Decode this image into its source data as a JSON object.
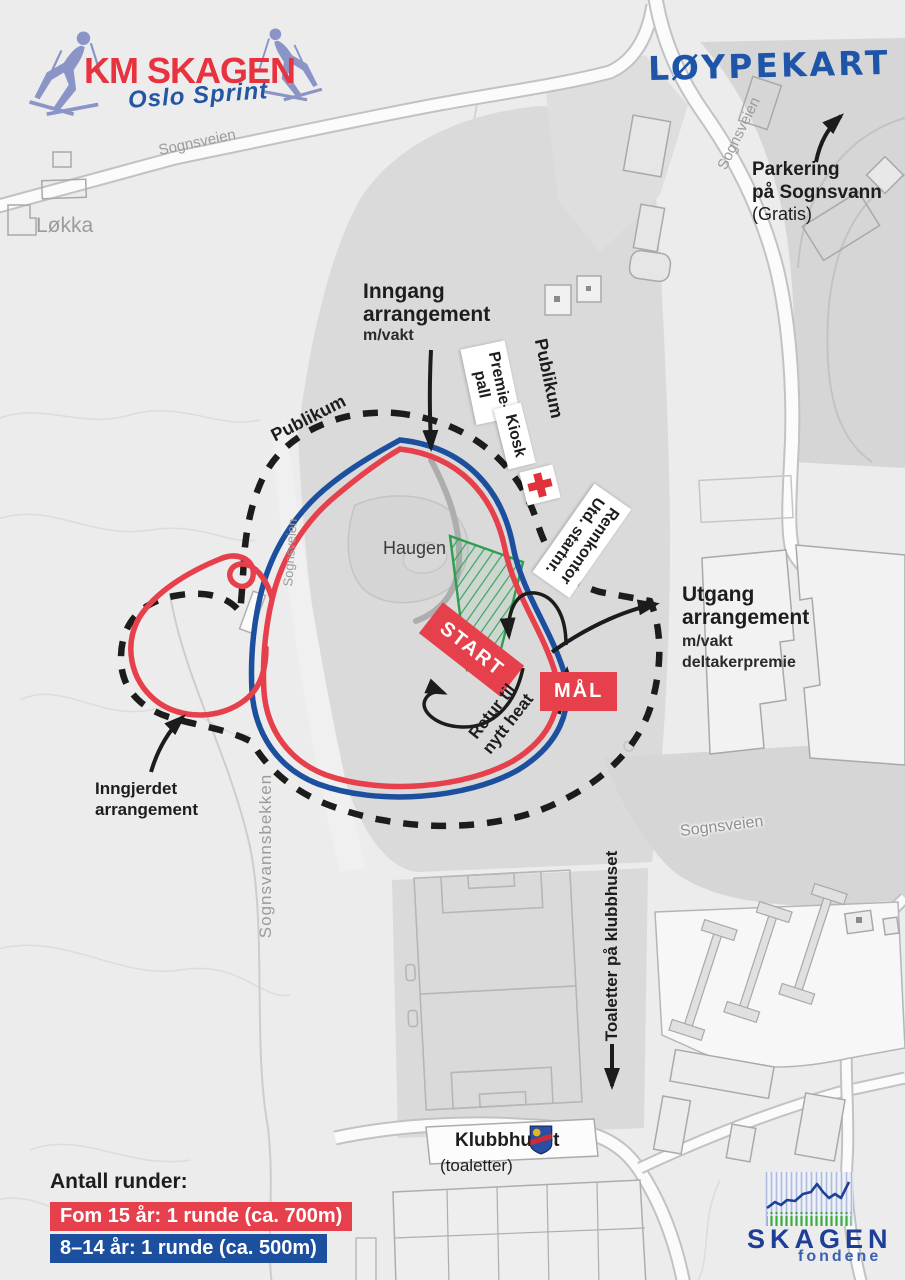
{
  "colors": {
    "course_red": "#e5404b",
    "course_blue": "#1d4f9f",
    "fence_black": "#1c1c1c",
    "start_zone_green": "#3aa659",
    "brand_red": "#e8323e",
    "brand_blue": "#2456a4",
    "logo_blue": "#1e3e97"
  },
  "header": {
    "event_logo": {
      "title": "KM SKAGEN",
      "subtitle": "Oslo Sprint"
    },
    "map_title": "LØYPEKART"
  },
  "annotations": {
    "parking": {
      "line1": "Parkering",
      "line2": "på Sognsvann",
      "line3": "(Gratis)"
    },
    "entrance": {
      "line1": "Inngang",
      "line2": "arrangement",
      "line3": "m/vakt"
    },
    "exit": {
      "line1": "Utgang",
      "line2": "arrangement",
      "line3": "m/vakt",
      "line4": "deltakerpremie"
    },
    "fenced_area": {
      "line1": "Inngjerdet",
      "line2": "arrangement"
    },
    "return_heat": {
      "line1": "Retur til",
      "line2": "nytt heat"
    },
    "toilets": "Toaletter på klubbhuset",
    "clubhouse": {
      "name": "Klubbhuset",
      "note": "(toaletter)"
    }
  },
  "facilities": {
    "podium": {
      "line1": "Premie-",
      "line2": "pall"
    },
    "kiosk": "Kiosk",
    "race_office": {
      "line1": "Rennkontor",
      "line2": "Utd. startnr."
    }
  },
  "course": {
    "start": "START",
    "finish": "MÅL"
  },
  "map_labels": {
    "lokka": "Løkka",
    "haugen": "Haugen",
    "publikum_west": "Publikum",
    "publikum_east": "Publikum",
    "sognsveien_nw": "Sognsveien",
    "sognsveien_ne": "Sognsveien",
    "sognsveien_west": "Sognsveien",
    "sognsveien_se": "Sognsveien",
    "sognsvannsbekken": "Sognsvannsbekken"
  },
  "legend": {
    "title": "Antall runder:",
    "items": [
      {
        "label": "Fom 15 år: 1 runde (ca. 700m)",
        "color": "#e5404b"
      },
      {
        "label": "8–14 år: 1 runde (ca. 500m)",
        "color": "#1d4f9f"
      }
    ]
  },
  "footer_logo": {
    "name": "SKAGEN",
    "subtitle": "fondene"
  }
}
